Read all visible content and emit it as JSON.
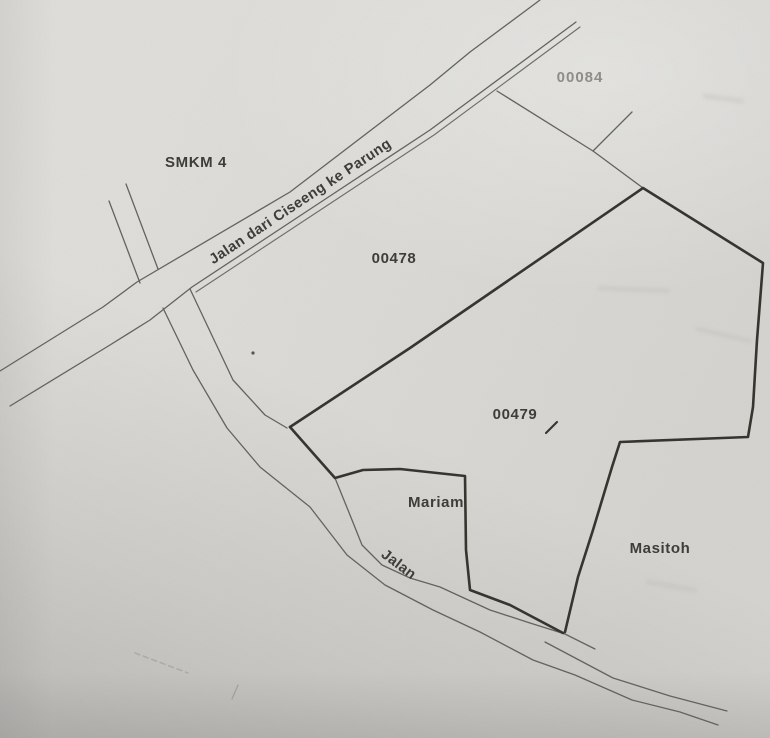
{
  "labels": {
    "school": "SMKM 4",
    "main_road": "Jalan dari Ciseeng ke Parung",
    "parcel_top": "00084",
    "parcel_left": "00478",
    "parcel_center": "00479",
    "owner_mariam": "Mariam",
    "owner_masitoh": "Masitoh",
    "lower_road": "Jalan"
  },
  "colors": {
    "paper": "#dcdbd7",
    "thin_line": "#63635e",
    "thick_line": "#34342f",
    "label_text": "#3e3e39",
    "faded_text": "#8f8f89"
  }
}
